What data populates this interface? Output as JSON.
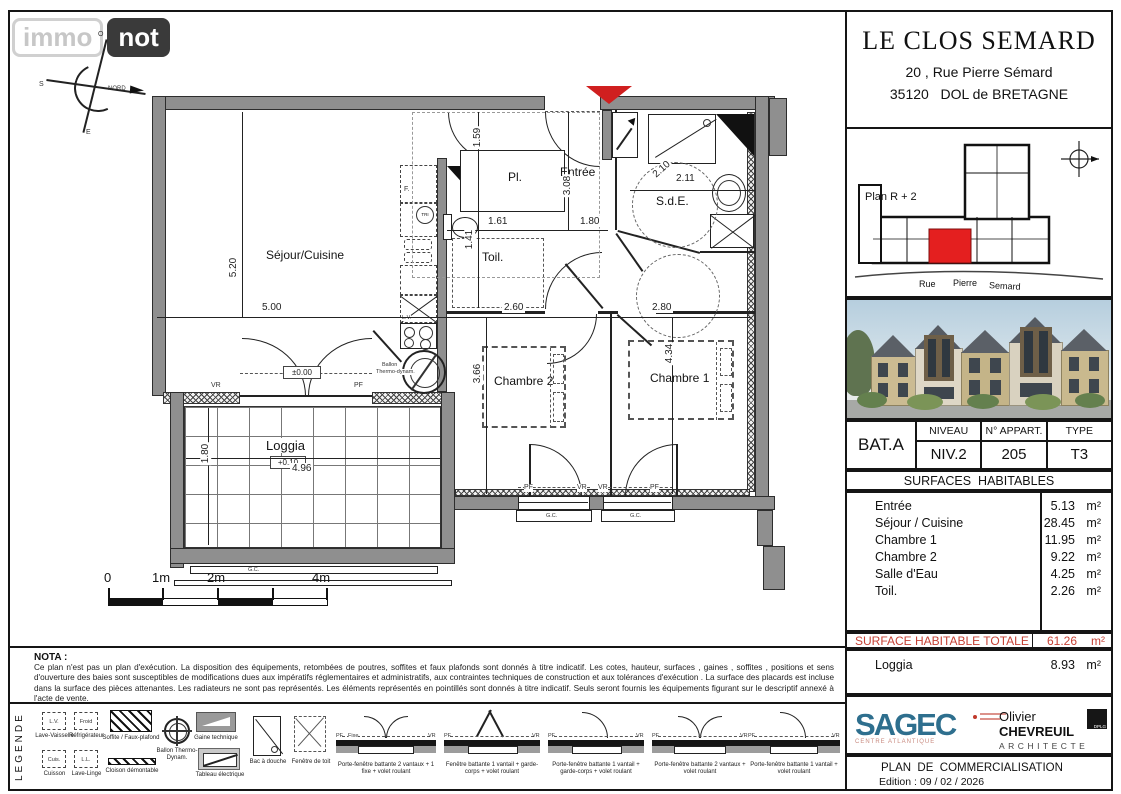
{
  "watermark": {
    "immo": "immo",
    "not": "not"
  },
  "compass": {
    "north": "NORD",
    "o": "O",
    "s": "S",
    "e": "E"
  },
  "title_block": {
    "title": "LE CLOS SEMARD",
    "address1": "20 , Rue Pierre Sémard",
    "address2": "35120   DOL de BRETAGNE"
  },
  "location_map": {
    "label": "Plan R + 2",
    "street1": "Rue",
    "street2": "Pierre",
    "street3": "Semard",
    "highlight_color": "#e41f1f"
  },
  "apartment": {
    "building": "BAT.A",
    "niveau_header": "NIVEAU",
    "niveau": "NIV.2",
    "appart_header": "N° APPART.",
    "appart": "205",
    "type_header": "TYPE",
    "type": "T3"
  },
  "surfaces": {
    "header": "SURFACES  HABITABLES",
    "rooms": [
      {
        "name": "Entrée",
        "area": "5.13",
        "unit": "m²"
      },
      {
        "name": "Séjour / Cuisine",
        "area": "28.45",
        "unit": "m²"
      },
      {
        "name": "Chambre 1",
        "area": "11.95",
        "unit": "m²"
      },
      {
        "name": "Chambre 2",
        "area": "9.22",
        "unit": "m²"
      },
      {
        "name": "Salle d'Eau",
        "area": "4.25",
        "unit": "m²"
      },
      {
        "name": "Toil.",
        "area": "2.26",
        "unit": "m²"
      }
    ],
    "total_label": "SURFACE HABITABLE TOTALE",
    "total_area": "61.26",
    "total_unit": "m²",
    "loggia_label": "Loggia",
    "loggia_area": "8.93",
    "loggia_unit": "m²"
  },
  "plan": {
    "rooms": {
      "sejour": "Séjour/Cuisine",
      "entree": "Entrée",
      "pl": "Pl.",
      "sde": "S.d.E.",
      "toil": "Toil.",
      "chambre1": "Chambre 1",
      "chambre2": "Chambre 2",
      "loggia": "Loggia"
    },
    "dims": {
      "sejour_h": "5.20",
      "sejour_w": "5.00",
      "pl_h": "1.59",
      "pl_w": "1.61",
      "entree_h": "3.08",
      "entree_w": "1.80",
      "sde_w": "2.11",
      "sde_diag": "2.10",
      "toil_h": "1.41",
      "ch2_w": "2.60",
      "ch2_h": "3.66",
      "ch1_w": "2.80",
      "ch1_h": "4.34",
      "loggia_w": "4.96",
      "loggia_h": "1.80"
    },
    "levels": {
      "entry": "±0.00",
      "loggia": "+0.10"
    },
    "annotations": {
      "vr": "VR",
      "pf": "PF",
      "gc": "G.C.",
      "fixe": "Fixe",
      "f": "F.",
      "tri": "TRI",
      "lv": "L.V.",
      "ballon_line1": "Ballon",
      "ballon_line2": "Thermo-dynam."
    }
  },
  "scale_bar": {
    "l0": "0",
    "l1": "1m",
    "l2": "2m",
    "l4": "4m"
  },
  "nota": {
    "title": "NOTA :",
    "text": "Ce plan n'est pas un plan d'exécution. La disposition des équipements, retombées de poutres, soffites et faux plafonds sont donnés à titre indicatif. Les cotes, hauteur, surfaces , gaines , soffites , positions et sens d'ouverture des baies sont susceptibles de modifications dues aux impératifs réglementaires et administratifs, aux contraintes techniques de construction et aux tolérances d'exécution . La surface des placards est incluse dans la surface des pièces attenantes. Les radiateurs ne sont pas représentés. Les éléments représentés en pointillés sont donnés à titre indicatif. Seuls seront fournis les équipements figurant sur le descriptif annexé à l'acte de vente."
  },
  "legend": {
    "title": "LEGENDE",
    "appliances": [
      {
        "abbr": "L.V.",
        "label": "Lave-Vaisselle"
      },
      {
        "abbr": "Froid",
        "label": "Réfrigérateur"
      },
      {
        "abbr": "Cuis.",
        "label": "Cuisson"
      },
      {
        "abbr": "L.L.",
        "label": "Lave-Linge"
      }
    ],
    "symbols": [
      {
        "label": "Soffite / Faux-plafond"
      },
      {
        "label": "Cloison démontable"
      },
      {
        "label": "Ballon Thermo-Dynam."
      },
      {
        "label": "Gaine technique"
      },
      {
        "label": "Tableau électrique"
      },
      {
        "label": "Bac à douche"
      },
      {
        "label": "Fenêtre de toit"
      }
    ],
    "windows": [
      "Porte-fenêtre battante 2 vantaux + 1 fixe + volet roulant",
      "Fenêtre battante 1 vantail + garde-corps + volet roulant",
      "Porte-fenêtre battante 1 vantail + garde-corps + volet roulant",
      "Porte-fenêtre battante 2 vantaux + volet roulant",
      "Porte-fenêtre battante 1 vantail + volet roulant"
    ]
  },
  "footer": {
    "sagec": "SAGEC",
    "sagec_sub": "CENTRE ATLANTIQUE",
    "architect_first": "Olivier",
    "architect_last": "CHEVREUIL",
    "architect_title": "ARCHITECTE",
    "architect_badge": "DPLG",
    "doc_title": "PLAN  DE  COMMERCIALISATION",
    "edition": "Edition : 09 / 02 / 2026"
  }
}
